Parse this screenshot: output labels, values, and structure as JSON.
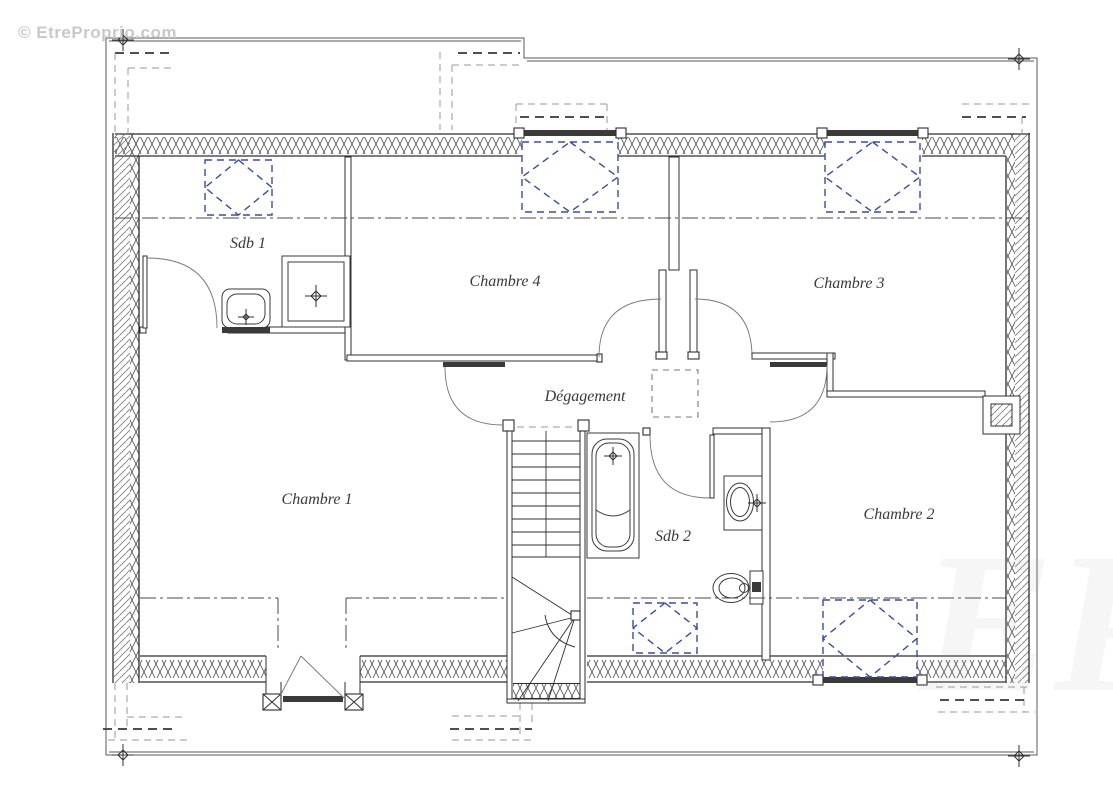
{
  "watermark": {
    "text": "© EtreProprio.com",
    "big_mark": "EP"
  },
  "rooms": [
    {
      "id": "sdb1",
      "label": "Sdb 1"
    },
    {
      "id": "chambre4",
      "label": "Chambre 4"
    },
    {
      "id": "chambre3",
      "label": "Chambre 3"
    },
    {
      "id": "degagement",
      "label": "Dégagement"
    },
    {
      "id": "chambre1",
      "label": "Chambre 1"
    },
    {
      "id": "sdb2",
      "label": "Sdb 2"
    },
    {
      "id": "chambre2",
      "label": "Chambre 2"
    }
  ],
  "symbols": {
    "roof_window_icons": 5,
    "ceiling_hatch_icons": 1,
    "survey_cross_icons": 4,
    "fixture_icons": [
      "shower",
      "washbasin",
      "bathtub",
      "toilet",
      "staircase"
    ]
  },
  "colors": {
    "line": "#2f2f2f",
    "roof_window_blue": "#3b4d9b",
    "dash_gray": "#9a9a9a",
    "label": "#3a3a3a",
    "watermark": "#c9c9c9",
    "paper": "#ffffff"
  }
}
